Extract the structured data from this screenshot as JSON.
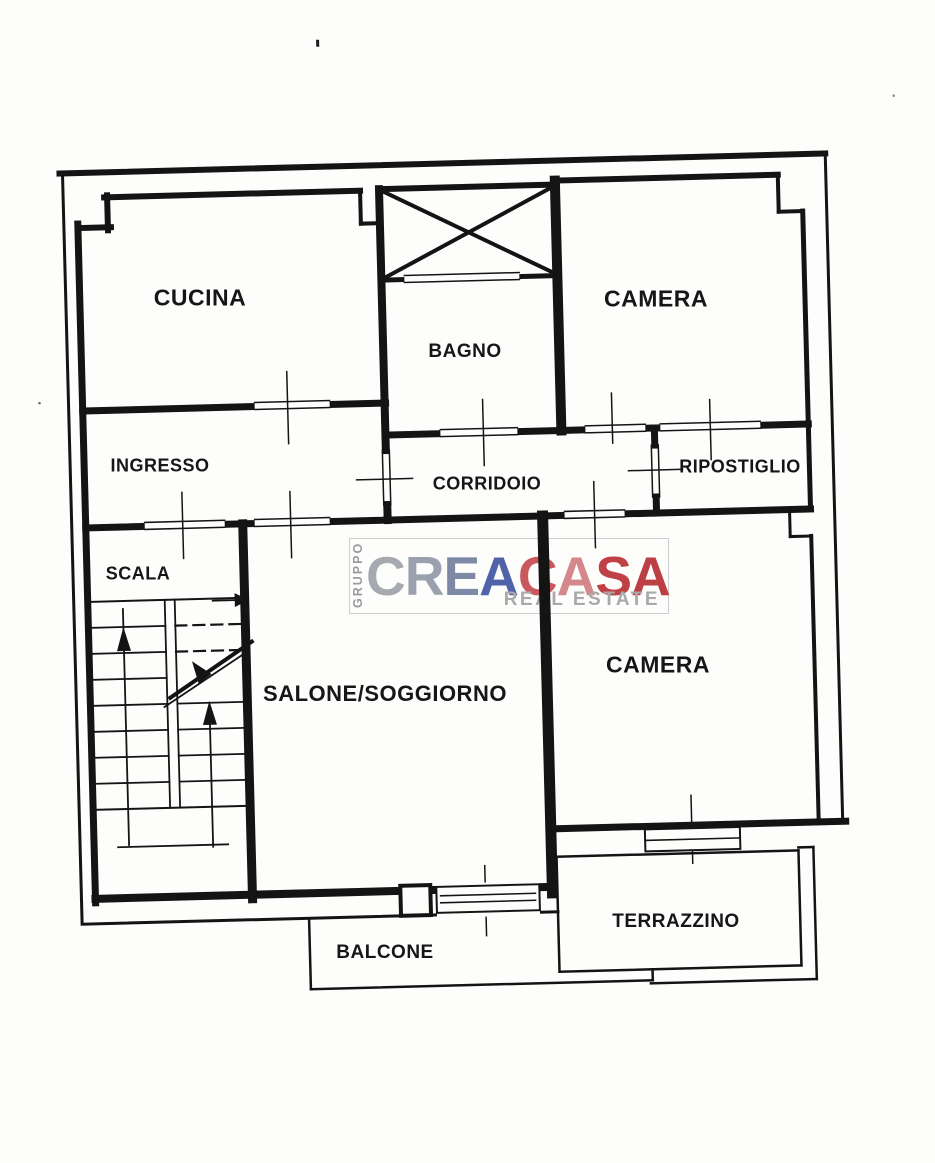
{
  "floor_plan": {
    "rooms": [
      {
        "id": "cucina",
        "label": "CUCINA"
      },
      {
        "id": "bagno",
        "label": "BAGNO"
      },
      {
        "id": "camera-top",
        "label": "CAMERA"
      },
      {
        "id": "ingresso",
        "label": "INGRESSO"
      },
      {
        "id": "corridoio",
        "label": "CORRIDOIO"
      },
      {
        "id": "ripostiglio",
        "label": "RIPOSTIGLIO"
      },
      {
        "id": "scala",
        "label": "SCALA"
      },
      {
        "id": "salone",
        "label": "SALONE/SOGGIORNO"
      },
      {
        "id": "camera-bottom",
        "label": "CAMERA"
      },
      {
        "id": "terrazzino",
        "label": "TERRAZZINO"
      },
      {
        "id": "balcone",
        "label": "BALCONE"
      }
    ]
  },
  "watermark": {
    "group_label": "GRUPPO",
    "brand_part1": "CREA",
    "brand_part2": "CASA",
    "tagline": "REAL ESTATE",
    "colors": {
      "gruppo": "#9b9b9b",
      "tagline": "#a9a9a9",
      "brand1_letter_colors": [
        "#a6a9b0",
        "#9aa1ae",
        "#7e89a6",
        "#5062a9"
      ],
      "brand2_letter_colors": [
        "#c9595c",
        "#d4888b",
        "#bf4145",
        "#bb3f43"
      ]
    }
  },
  "colors": {
    "ink": "#141414",
    "paper": "#fdfdfc"
  }
}
